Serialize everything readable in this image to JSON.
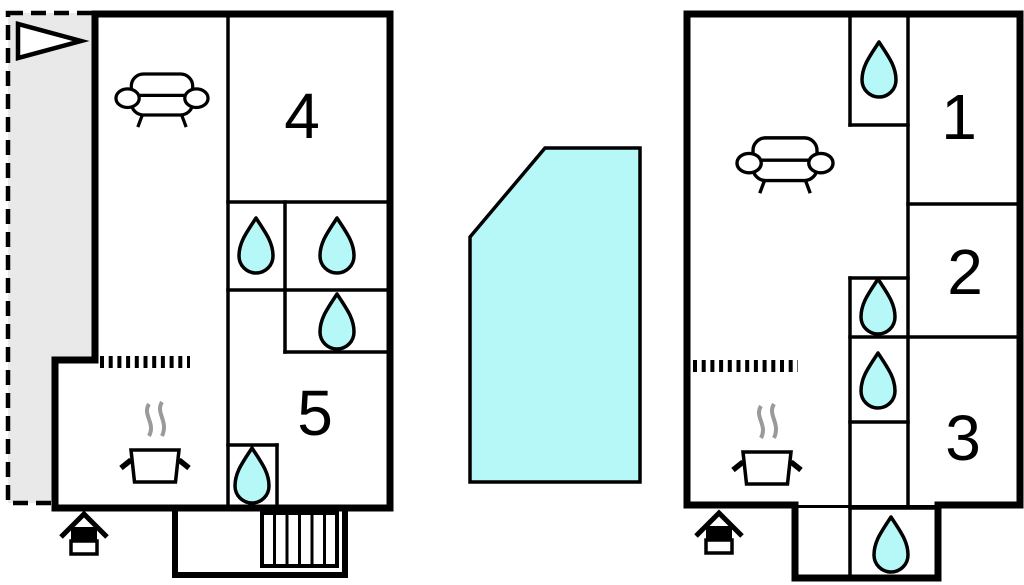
{
  "page": {
    "type": "floor-plan-drawing",
    "background": "#ffffff"
  },
  "colors": {
    "water": "#b6f7f7",
    "terrace_fill": "#e9e9e9",
    "line": "#000000",
    "steam": "#9a9a9a"
  },
  "left_plan": {
    "rooms": [
      {
        "label": "4"
      },
      {
        "label": "5"
      }
    ],
    "features": [
      "terrace-dashed-area",
      "flag-icon",
      "sofa-icon",
      "water-drop-icon",
      "water-drop-icon",
      "water-drop-icon",
      "water-drop-icon",
      "kitchen-divider-dotted",
      "cooking-pot-icon",
      "stairs-icon",
      "grill-icon"
    ]
  },
  "right_plan": {
    "rooms": [
      {
        "label": "1"
      },
      {
        "label": "2"
      },
      {
        "label": "3"
      }
    ],
    "features": [
      "sofa-icon",
      "water-drop-icon",
      "water-drop-icon",
      "water-drop-icon",
      "water-drop-icon",
      "kitchen-divider-dotted",
      "cooking-pot-icon",
      "grill-icon"
    ]
  },
  "pool": {
    "name": "swimming-pool",
    "shape": "pentagon",
    "color": "#b6f7f7"
  }
}
